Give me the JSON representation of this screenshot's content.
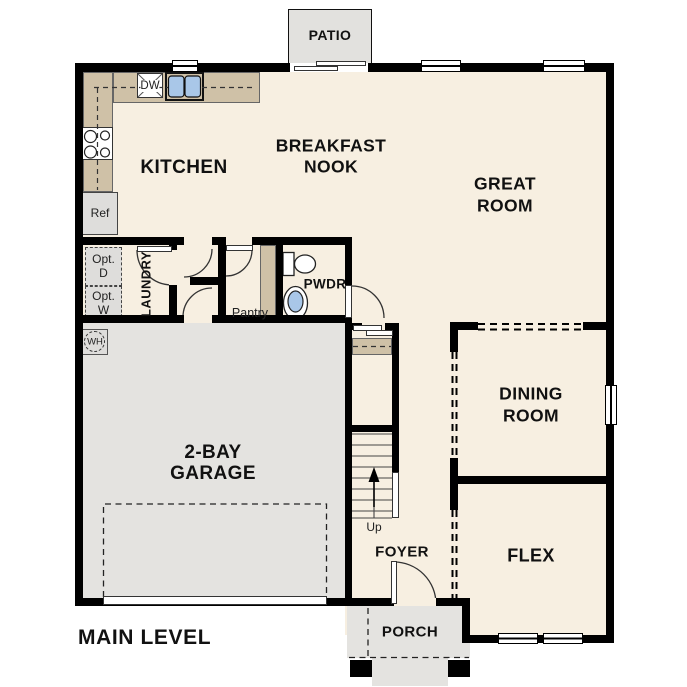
{
  "plan_title": "MAIN LEVEL",
  "rooms": {
    "kitchen": "KITCHEN",
    "breakfast_nook": [
      "BREAKFAST",
      "NOOK"
    ],
    "great_room": [
      "GREAT",
      "ROOM"
    ],
    "dining_room": [
      "DINING",
      "ROOM"
    ],
    "garage": [
      "2-BAY",
      "GARAGE"
    ],
    "flex": "FLEX",
    "foyer": "FOYER",
    "laundry": "LAUNDRY",
    "powder": "PWDR",
    "pantry": "Pantry",
    "patio": "PATIO",
    "porch": "PORCH"
  },
  "fixtures": {
    "dishwasher": "DW",
    "refrigerator": "Ref",
    "water_heater": "WH",
    "stairs_direction": "Up",
    "optional_dryer": [
      "Opt.",
      "D"
    ],
    "optional_washer": [
      "Opt.",
      "W"
    ]
  },
  "colors": {
    "wall": "#000000",
    "floor": "#f7efe1",
    "garage_floor": "#e4e3e0",
    "counter": "#cfc1a7",
    "fixture_blue": "#a9c7e8"
  }
}
